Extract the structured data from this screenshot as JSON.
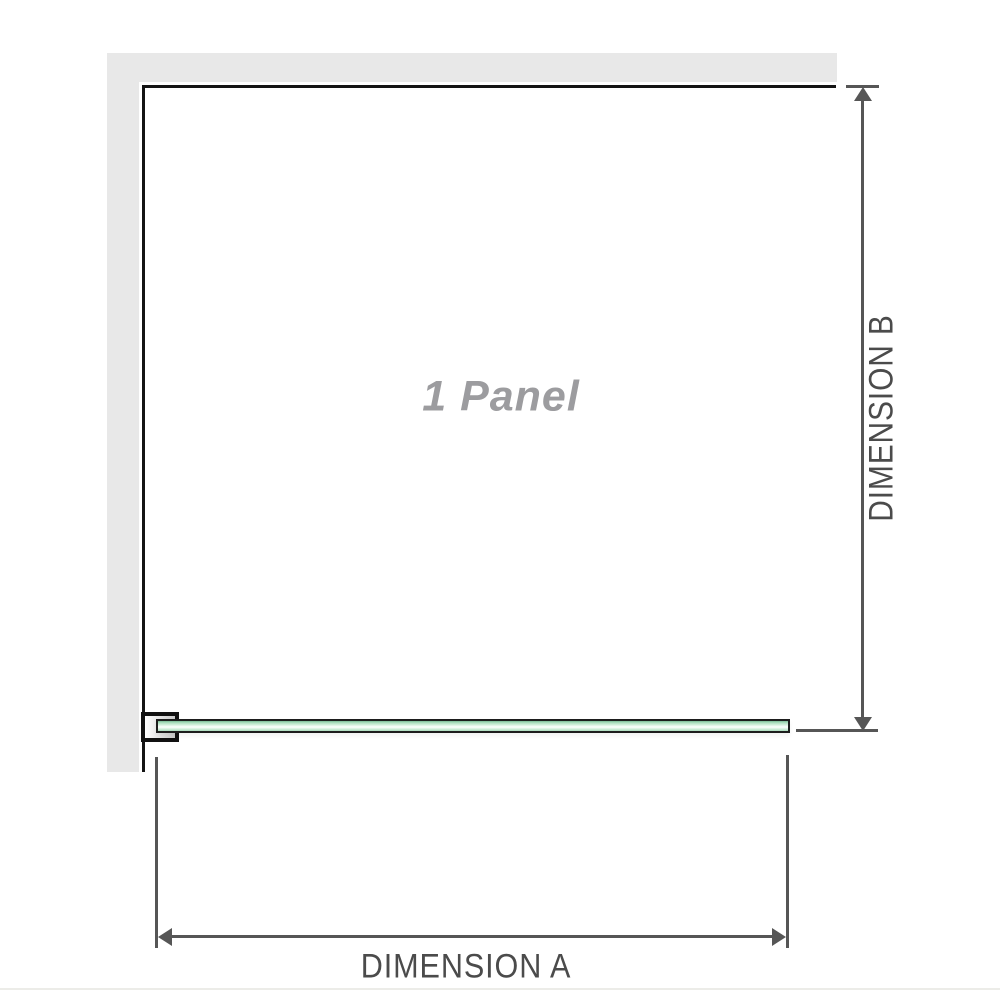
{
  "diagram": {
    "panel_title": "1 Panel",
    "dimension_a_label": "DIMENSION A",
    "dimension_b_label": "DIMENSION B"
  },
  "colors": {
    "wall": "#e8e8e8",
    "panel_edge": "#141414",
    "clamp_border": "#111111",
    "glass_border": "#1d1d1d",
    "glass_green_dark": "#7ab995",
    "glass_green_mid": "#a9dcbc",
    "glass_green_light": "#dcf2e3",
    "dimension_line": "#565656",
    "dimension_text": "#4b4b4b",
    "panel_title_text": "#9c9c9f",
    "page_edge_line": "#ecece8"
  }
}
